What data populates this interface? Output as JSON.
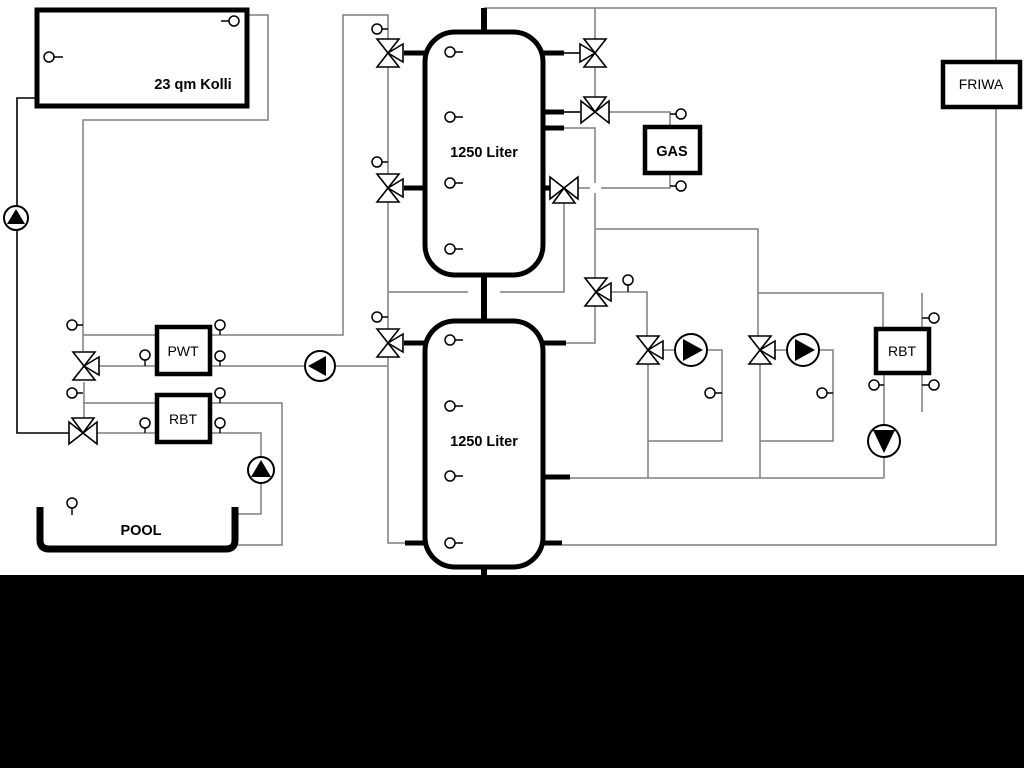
{
  "diagram": {
    "title": "Heating system hydraulic schematic",
    "labels": {
      "collector": "23 qm Kolli",
      "tank_top": "1250 Liter",
      "tank_bottom": "1250 Liter",
      "gas": "GAS",
      "friwa": "FRIWA",
      "pwt": "PWT",
      "rbt_solar": "RBT",
      "rbt_right": "RBT",
      "pool": "POOL"
    },
    "colors": {
      "pipe_gray": "#7f7f7f",
      "ink_black": "#000000",
      "paper_white": "#ffffff",
      "bottom_band": "#000000"
    },
    "icons": {
      "pump": "circle-with-flow-triangle",
      "three_way_valve": "triple-triangle-valve",
      "sensor": "small-circle-probe"
    }
  }
}
